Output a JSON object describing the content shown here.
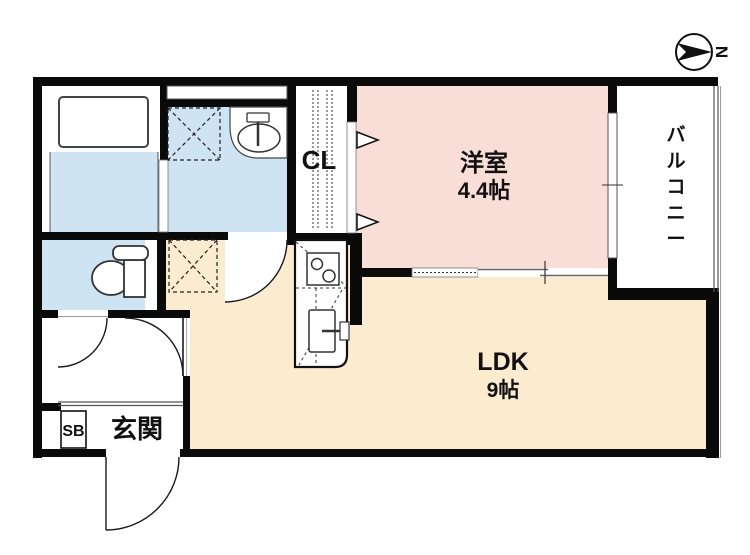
{
  "plan": {
    "compass": {
      "label": "N"
    },
    "rooms": {
      "western": {
        "name": "洋室",
        "size": "4.4帖"
      },
      "ldk": {
        "name": "LDK",
        "size": "9帖"
      },
      "balcony": {
        "name": "バルコニー",
        "chars": [
          "バ",
          "ル",
          "コ",
          "ニ",
          "ー"
        ]
      },
      "closet": {
        "label": "CL"
      },
      "entrance": {
        "label": "玄関"
      },
      "shoe_box": {
        "label": "SB"
      }
    },
    "colors": {
      "wall": "#0a0a0a",
      "western_fill": "#f9ded7",
      "ldk_fill": "#fbeccf",
      "wet_fill": "#cfe4f2"
    }
  }
}
